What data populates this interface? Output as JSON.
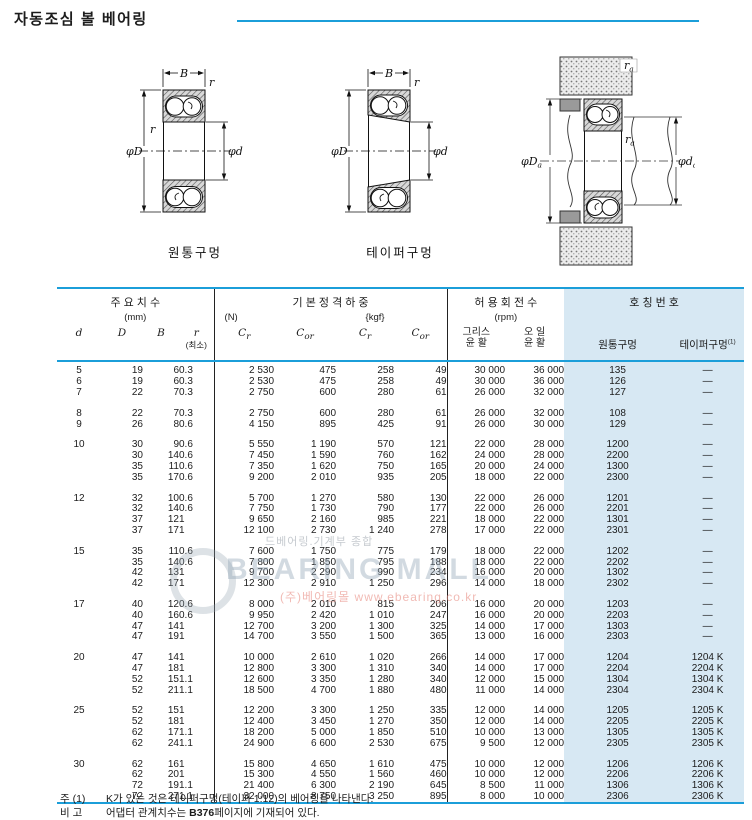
{
  "page": {
    "title": "자동조심 볼 베어링"
  },
  "diagrams": {
    "caption_cylindrical": "원통구멍",
    "caption_tapered": "테이퍼구멍",
    "labels": {
      "B": "B",
      "r": "r",
      "phiD": "φD",
      "phid": "φd",
      "suba": "a"
    }
  },
  "watermark": {
    "line1": "드베어링.기계부 종합",
    "brand": "BEARING MALL",
    "line2": "(주)베어링몰 www.ebearing.co.kr"
  },
  "table": {
    "header": {
      "dims_label": "주 요 치 수",
      "dims_unit": "(mm)",
      "load_label": "기 본 정 격 하 중",
      "load_unit_n": "(N)",
      "load_unit_kgf": "{kgf}",
      "speed_label": "허 용 회 전 수",
      "speed_unit": "(rpm)",
      "number_label": "호 칭 번 호",
      "col_d": "d",
      "col_D": "D",
      "col_B": "B",
      "col_r": "r",
      "col_r_min": "(최소)",
      "c_sym": "C",
      "sub_r": "r",
      "sub_or": "or",
      "grease_1": "그리스",
      "grease_2": "윤 활",
      "oil_1": "오 일",
      "oil_2": "윤 활",
      "cyl": "원통구멍",
      "taper": "테이퍼구멍",
      "taper_sup": "(1)"
    },
    "groups": [
      {
        "rows": [
          [
            "5",
            "19",
            "6",
            "0.3",
            "2 530",
            "475",
            "258",
            "49",
            "30 000",
            "36 000",
            "135",
            "—"
          ],
          [
            "6",
            "19",
            "6",
            "0.3",
            "2 530",
            "475",
            "258",
            "49",
            "30 000",
            "36 000",
            "126",
            "—"
          ],
          [
            "7",
            "22",
            "7",
            "0.3",
            "2 750",
            "600",
            "280",
            "61",
            "26 000",
            "32 000",
            "127",
            "—"
          ]
        ]
      },
      {
        "rows": [
          [
            "8",
            "22",
            "7",
            "0.3",
            "2 750",
            "600",
            "280",
            "61",
            "26 000",
            "32 000",
            "108",
            "—"
          ],
          [
            "9",
            "26",
            "8",
            "0.6",
            "4 150",
            "895",
            "425",
            "91",
            "26 000",
            "30 000",
            "129",
            "—"
          ]
        ]
      },
      {
        "rows": [
          [
            "10",
            "30",
            "9",
            "0.6",
            "5 550",
            "1 190",
            "570",
            "121",
            "22 000",
            "28 000",
            "1200",
            "—"
          ],
          [
            "",
            "30",
            "14",
            "0.6",
            "7 450",
            "1 590",
            "760",
            "162",
            "24 000",
            "28 000",
            "2200",
            "—"
          ],
          [
            "",
            "35",
            "11",
            "0.6",
            "7 350",
            "1 620",
            "750",
            "165",
            "20 000",
            "24 000",
            "1300",
            "—"
          ],
          [
            "",
            "35",
            "17",
            "0.6",
            "9 200",
            "2 010",
            "935",
            "205",
            "18 000",
            "22 000",
            "2300",
            "—"
          ]
        ]
      },
      {
        "rows": [
          [
            "12",
            "32",
            "10",
            "0.6",
            "5 700",
            "1 270",
            "580",
            "130",
            "22 000",
            "26 000",
            "1201",
            "—"
          ],
          [
            "",
            "32",
            "14",
            "0.6",
            "7 750",
            "1 730",
            "790",
            "177",
            "22 000",
            "26 000",
            "2201",
            "—"
          ],
          [
            "",
            "37",
            "12",
            "1",
            "9 650",
            "2 160",
            "985",
            "221",
            "18 000",
            "22 000",
            "1301",
            "—"
          ],
          [
            "",
            "37",
            "17",
            "1",
            "12 100",
            "2 730",
            "1 240",
            "278",
            "17 000",
            "22 000",
            "2301",
            "—"
          ]
        ]
      },
      {
        "rows": [
          [
            "15",
            "35",
            "11",
            "0.6",
            "7 600",
            "1 750",
            "775",
            "179",
            "18 000",
            "22 000",
            "1202",
            "—"
          ],
          [
            "",
            "35",
            "14",
            "0.6",
            "7 800",
            "1 850",
            "795",
            "188",
            "18 000",
            "22 000",
            "2202",
            "—"
          ],
          [
            "",
            "42",
            "13",
            "1",
            "9 700",
            "2 290",
            "990",
            "234",
            "16 000",
            "20 000",
            "1302",
            "—"
          ],
          [
            "",
            "42",
            "17",
            "1",
            "12 300",
            "2 910",
            "1 250",
            "296",
            "14 000",
            "18 000",
            "2302",
            "—"
          ]
        ]
      },
      {
        "rows": [
          [
            "17",
            "40",
            "12",
            "0.6",
            "8 000",
            "2 010",
            "815",
            "206",
            "16 000",
            "20 000",
            "1203",
            "—"
          ],
          [
            "",
            "40",
            "16",
            "0.6",
            "9 950",
            "2 420",
            "1 010",
            "247",
            "16 000",
            "20 000",
            "2203",
            "—"
          ],
          [
            "",
            "47",
            "14",
            "1",
            "12 700",
            "3 200",
            "1 300",
            "325",
            "14 000",
            "17 000",
            "1303",
            "—"
          ],
          [
            "",
            "47",
            "19",
            "1",
            "14 700",
            "3 550",
            "1 500",
            "365",
            "13 000",
            "16 000",
            "2303",
            "—"
          ]
        ]
      },
      {
        "rows": [
          [
            "20",
            "47",
            "14",
            "1",
            "10 000",
            "2 610",
            "1 020",
            "266",
            "14 000",
            "17 000",
            "1204",
            "1204 K"
          ],
          [
            "",
            "47",
            "18",
            "1",
            "12 800",
            "3 300",
            "1 310",
            "340",
            "14 000",
            "17 000",
            "2204",
            "2204 K"
          ],
          [
            "",
            "52",
            "15",
            "1.1",
            "12 600",
            "3 350",
            "1 280",
            "340",
            "12 000",
            "15 000",
            "1304",
            "1304 K"
          ],
          [
            "",
            "52",
            "21",
            "1.1",
            "18 500",
            "4 700",
            "1 880",
            "480",
            "11 000",
            "14 000",
            "2304",
            "2304 K"
          ]
        ]
      },
      {
        "rows": [
          [
            "25",
            "52",
            "15",
            "1",
            "12 200",
            "3 300",
            "1 250",
            "335",
            "12 000",
            "14 000",
            "1205",
            "1205 K"
          ],
          [
            "",
            "52",
            "18",
            "1",
            "12 400",
            "3 450",
            "1 270",
            "350",
            "12 000",
            "14 000",
            "2205",
            "2205 K"
          ],
          [
            "",
            "62",
            "17",
            "1.1",
            "18 200",
            "5 000",
            "1 850",
            "510",
            "10 000",
            "13 000",
            "1305",
            "1305 K"
          ],
          [
            "",
            "62",
            "24",
            "1.1",
            "24 900",
            "6 600",
            "2 530",
            "675",
            "9 500",
            "12 000",
            "2305",
            "2305 K"
          ]
        ]
      },
      {
        "rows": [
          [
            "30",
            "62",
            "16",
            "1",
            "15 800",
            "4 650",
            "1 610",
            "475",
            "10 000",
            "12 000",
            "1206",
            "1206 K"
          ],
          [
            "",
            "62",
            "20",
            "1",
            "15 300",
            "4 550",
            "1 560",
            "460",
            "10 000",
            "12 000",
            "2206",
            "2206 K"
          ],
          [
            "",
            "72",
            "19",
            "1.1",
            "21 400",
            "6 300",
            "2 190",
            "645",
            "8 500",
            "11 000",
            "1306",
            "1306 K"
          ],
          [
            "",
            "72",
            "27",
            "1.1",
            "32 000",
            "8 750",
            "3 250",
            "895",
            "8 000",
            "10 000",
            "2306",
            "2306 K"
          ]
        ]
      }
    ]
  },
  "notes": {
    "note1_label": "주 (1)",
    "note1_text": "K가 있는 것은 테이퍼구멍(테이퍼 1:12)의 베어링을 나타낸다.",
    "note2_label": "비 고",
    "note2_before": "어댑터 관계치수는 ",
    "note2_bold": "B376",
    "note2_after": "페이지에 기재되어 있다."
  }
}
